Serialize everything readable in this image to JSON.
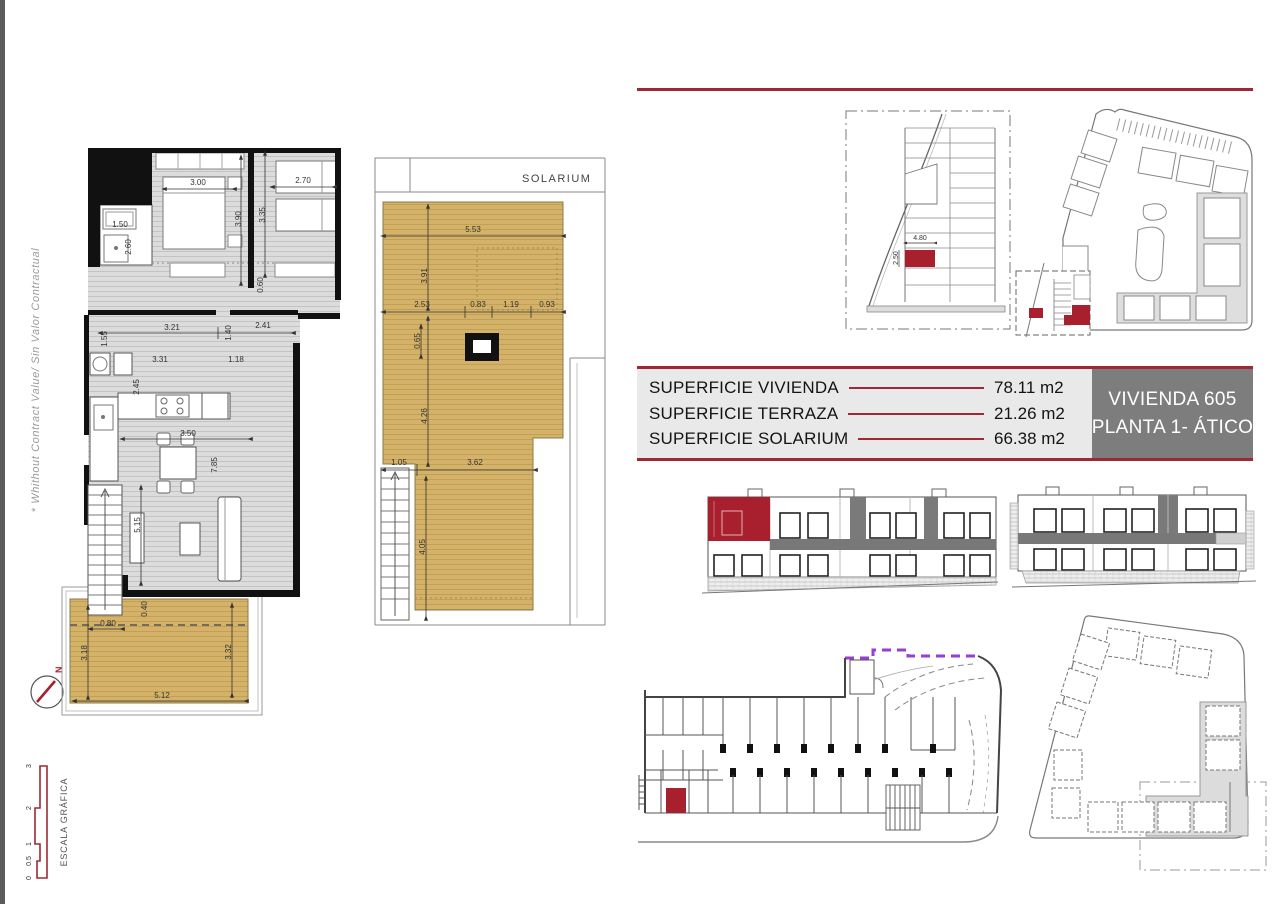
{
  "side_note": "* Whithout Contract Value/ Sin Valor Contractual",
  "north": {
    "label": "N"
  },
  "scale_bar": {
    "label": "ESCALA GRÁFICA",
    "ticks": [
      "0",
      "0.5",
      "1",
      "2",
      "3"
    ]
  },
  "floor_plan": {
    "dims": {
      "d300": "3.00",
      "d390": "3.90",
      "d270": "2.70",
      "d335": "3.35",
      "d150": "1.50",
      "d260": "2.60",
      "d321": "3.21",
      "d241": "2.41",
      "d155": "1.55",
      "d140": "1.40",
      "d331": "3.31",
      "d118": "1.18",
      "d245": "2.45",
      "d350": "3.50",
      "d785": "7.85",
      "d515": "5.15",
      "d060": "0.60",
      "d040": "0.40",
      "d080": "0.80",
      "d318": "3.18",
      "d332": "3.32",
      "d512": "5.12"
    }
  },
  "solarium_plan": {
    "title": "SOLARIUM",
    "dims": {
      "d553": "5.53",
      "d391": "3.91",
      "d253": "2.53",
      "d083": "0.83",
      "d119": "1.19",
      "d093": "0.93",
      "d065": "0.65",
      "d426": "4.26",
      "d105": "1.05",
      "d362": "3.62",
      "d405": "4.05"
    }
  },
  "parking_plan": {
    "dims": {
      "width": "4.80",
      "depth": "2.50"
    }
  },
  "area_table": {
    "rows": [
      {
        "label": "SUPERFICIE VIVIENDA",
        "value": "78.11 m2"
      },
      {
        "label": "SUPERFICIE TERRAZA",
        "value": "21.26 m2"
      },
      {
        "label": "SUPERFICIE SOLARIUM",
        "value": "66.38 m2"
      }
    ]
  },
  "unit_box": {
    "line1": "VIVIENDA 605",
    "line2": "PLANTA 1- ÁTICO"
  },
  "colors": {
    "accent_red": "#9e2935",
    "highlight_red": "#a8202e",
    "terrace_tan": "#d4b269",
    "unit_box_gray": "#7d7d7d",
    "ramp_purple": "#9a3dd4"
  }
}
